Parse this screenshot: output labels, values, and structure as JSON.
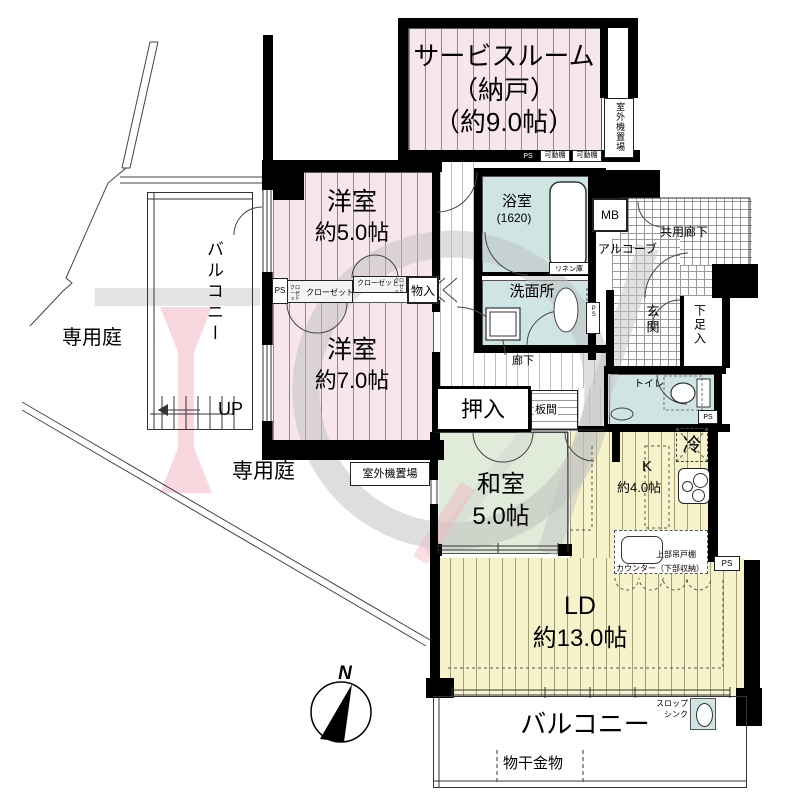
{
  "rooms": {
    "service_room": {
      "name": "サービスルーム",
      "alt": "（納戸）",
      "size": "（約9.0帖）"
    },
    "western_5": {
      "name": "洋室",
      "size": "約5.0帖"
    },
    "western_7": {
      "name": "洋室",
      "size": "約7.0帖"
    },
    "japanese": {
      "name": "和室",
      "size": "5.0帖"
    },
    "living_dining": {
      "name": "LD",
      "size": "約13.0帖"
    },
    "kitchen": {
      "name": "K",
      "size": "約4.0帖"
    },
    "bathroom": {
      "name": "浴室",
      "size": "(1620)"
    },
    "washroom": {
      "name": "洗面所"
    },
    "toilet": {
      "name": "トイレ"
    },
    "corridor": {
      "name": "廊下"
    },
    "common_corridor": {
      "name": "共用廊下"
    },
    "alcove": {
      "name": "アルコーブ"
    },
    "entrance": {
      "name": "玄関"
    },
    "shoe_cabinet": {
      "name": "下足入"
    },
    "futon_closet": {
      "name": "押入"
    },
    "board_floor": {
      "name": "板間"
    },
    "storage": {
      "name": "物入"
    }
  },
  "exterior": {
    "balcony_side": "バルコニー",
    "balcony_south": "バルコニー",
    "private_garden_upper": "専用庭",
    "private_garden_lower": "専用庭",
    "outdoor_unit_upper": "室外機置場",
    "outdoor_unit_lower": "室外機置場",
    "laundry_fitting": "物干金物",
    "slop_sink": {
      "line1": "スロップ",
      "line2": "シンク"
    },
    "stairs_up": "UP"
  },
  "fixtures": {
    "refrigerator": "冷",
    "linen_cabinet": "リネン庫",
    "upper_hanging_cupboard": "上部吊戸棚",
    "counter": "カウンター（下部収納）",
    "meter_box": "MB",
    "pipe_space": "PS",
    "movable_shelf": "可動棚",
    "closet": "クローゼット"
  },
  "compass": {
    "north": "N"
  },
  "colors": {
    "wall": "#000000",
    "western_room": "#f7e6ee",
    "wet_area": "#cfe5e4",
    "tatami": "#e0ebd9",
    "wood_floor": "#f6f3cb",
    "watermark_pink": "#f3b6c3",
    "watermark_gray": "#c4c4c4"
  }
}
